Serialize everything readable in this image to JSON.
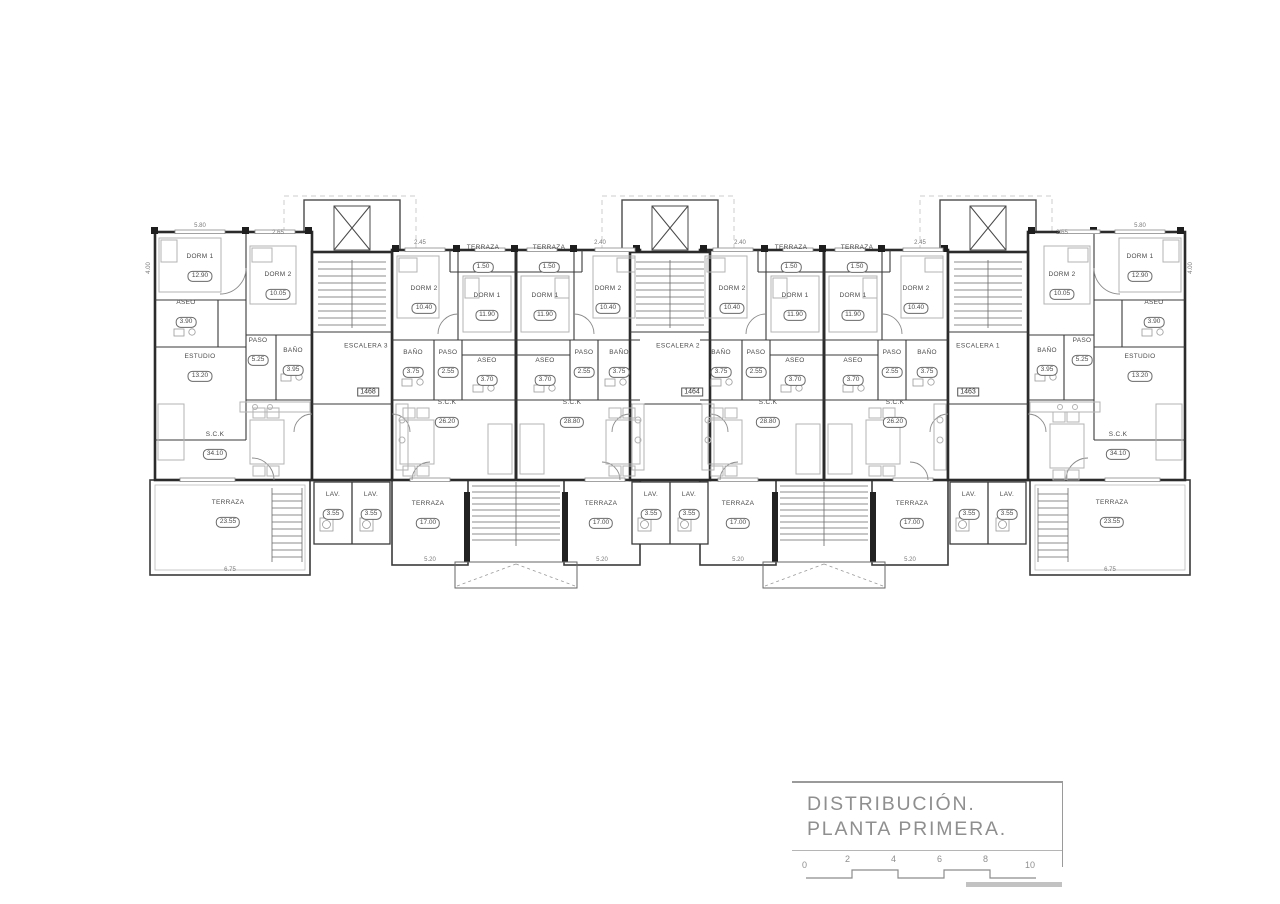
{
  "title_block": {
    "line1": "DISTRIBUCIÓN.",
    "line2": "PLANTA PRIMERA.",
    "scale_ticks": [
      "0",
      "2",
      "4",
      "6",
      "8",
      "10"
    ]
  },
  "stair_labels": [
    "ESCALERA 3",
    "ESCALERA 2",
    "ESCALERA 1"
  ],
  "unit_numbers": [
    "1468",
    "1464",
    "1463"
  ],
  "rooms": [
    {
      "name": "DORM 1",
      "area": "12.90"
    },
    {
      "name": "DORM 2",
      "area": "10.05"
    },
    {
      "name": "ASEO",
      "area": "3.90"
    },
    {
      "name": "PASO",
      "area": "5.25"
    },
    {
      "name": "BAÑO",
      "area": "3.95"
    },
    {
      "name": "ESTUDIO",
      "area": "13.20"
    },
    {
      "name": "S.C.K",
      "area": "34.10"
    },
    {
      "name": "TERRAZA",
      "area": "23.55"
    },
    {
      "name": "TERRAZA",
      "area": "1.50"
    },
    {
      "name": "DORM 2",
      "area": "10.40"
    },
    {
      "name": "DORM 1",
      "area": "11.90"
    },
    {
      "name": "BAÑO",
      "area": "3.75"
    },
    {
      "name": "PASO",
      "area": "2.55"
    },
    {
      "name": "ASEO",
      "area": "3.70"
    },
    {
      "name": "S.C.K",
      "area": "26.20"
    },
    {
      "name": "TERRAZA",
      "area": "17.00"
    },
    {
      "name": "TERRAZA",
      "area": "1.50"
    },
    {
      "name": "DORM 1",
      "area": "11.90"
    },
    {
      "name": "DORM 2",
      "area": "10.40"
    },
    {
      "name": "ASEO",
      "area": "3.70"
    },
    {
      "name": "PASO",
      "area": "2.55"
    },
    {
      "name": "BAÑO",
      "area": "3.75"
    },
    {
      "name": "S.C.K",
      "area": "28.80"
    },
    {
      "name": "TERRAZA",
      "area": "17.00"
    },
    {
      "name": "TERRAZA",
      "area": "1.50"
    },
    {
      "name": "DORM 2",
      "area": "10.40"
    },
    {
      "name": "DORM 1",
      "area": "11.90"
    },
    {
      "name": "BAÑO",
      "area": "3.75"
    },
    {
      "name": "PASO",
      "area": "2.55"
    },
    {
      "name": "ASEO",
      "area": "3.70"
    },
    {
      "name": "S.C.K",
      "area": "28.80"
    },
    {
      "name": "TERRAZA",
      "area": "17.00"
    },
    {
      "name": "TERRAZA",
      "area": "1.50"
    },
    {
      "name": "DORM 1",
      "area": "11.90"
    },
    {
      "name": "DORM 2",
      "area": "10.40"
    },
    {
      "name": "ASEO",
      "area": "3.70"
    },
    {
      "name": "PASO",
      "area": "2.55"
    },
    {
      "name": "BAÑO",
      "area": "3.75"
    },
    {
      "name": "S.C.K",
      "area": "26.20"
    },
    {
      "name": "TERRAZA",
      "area": "17.00"
    },
    {
      "name": "DORM 1",
      "area": "12.90"
    },
    {
      "name": "DORM 2",
      "area": "10.05"
    },
    {
      "name": "ASEO",
      "area": "3.90"
    },
    {
      "name": "PASO",
      "area": "5.25"
    },
    {
      "name": "BAÑO",
      "area": "3.95"
    },
    {
      "name": "ESTUDIO",
      "area": "13.20"
    },
    {
      "name": "S.C.K",
      "area": "34.10"
    },
    {
      "name": "TERRAZA",
      "area": "23.55"
    },
    {
      "name": "LAV.",
      "area": "3.55"
    },
    {
      "name": "LAV.",
      "area": "3.55"
    },
    {
      "name": "LAV.",
      "area": "3.55"
    },
    {
      "name": "LAV.",
      "area": "3.55"
    },
    {
      "name": "LAV.",
      "area": "3.55"
    },
    {
      "name": "LAV.",
      "area": "3.55"
    }
  ],
  "dims": [
    "5.80",
    "2.65",
    "2.45",
    "2.40",
    "2.40",
    "2.45",
    "2.65",
    "5.80",
    "6.75",
    "5.20",
    "5.20",
    "5.20",
    "5.20",
    "6.75",
    "4.00",
    "4.00"
  ],
  "colors": {
    "wall": "#2b2b2b",
    "partition": "#3a3a3a",
    "furniture": "#b3b3b3",
    "light": "#8a8a8a",
    "title": "#8f8f8f"
  }
}
